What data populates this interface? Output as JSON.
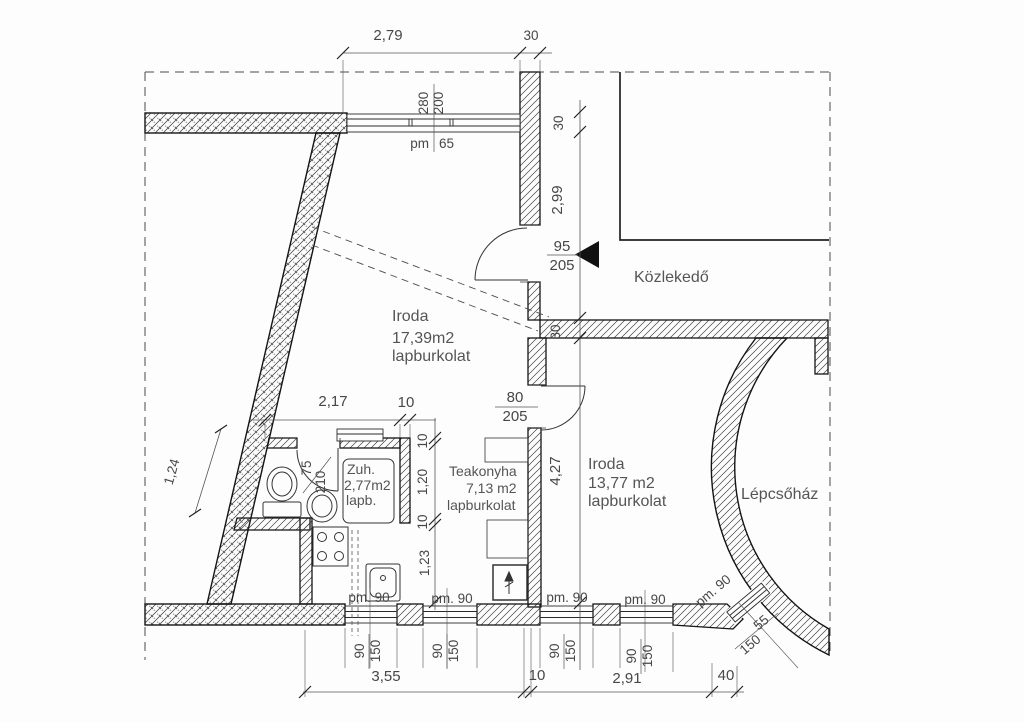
{
  "rooms": {
    "iroda1": {
      "l1": "Iroda",
      "l2": "17,39m2",
      "l3": "lapburkolat"
    },
    "iroda2": {
      "l1": "Iroda",
      "l2": "13,77 m2",
      "l3": "lapburkolat"
    },
    "teakonyha": {
      "l1": "Teakonyha",
      "l2": "7,13 m2",
      "l3": "lapburkolat"
    },
    "zuhanyzo": {
      "l1": "Zuh.",
      "l2": "2,77m2",
      "l3": "lapb."
    },
    "kozlekedo": {
      "l1": "Közlekedő"
    },
    "lepcsohaz": {
      "l1": "Lépcsőház"
    }
  },
  "dims": {
    "top_width": "2,79",
    "top_wall": "30",
    "win_top": {
      "w": "280",
      "h": "200",
      "pm": "pm",
      "sill": "65"
    },
    "right": {
      "wall_top": "30",
      "len": "2,99",
      "wall_mid": "30",
      "len2": "4,27"
    },
    "entry": {
      "w": "95",
      "h": "205"
    },
    "door2": {
      "w": "80",
      "h": "205"
    },
    "bath": {
      "width": "2,17",
      "wall": "10"
    },
    "bathdoor": {
      "w": "75",
      "h": "210"
    },
    "left_chain": {
      "a": "10",
      "b": "1,20",
      "c": "10",
      "d": "1,23"
    },
    "diag": "1,24",
    "bottom": {
      "d1": "3,55",
      "d2": "10",
      "d3": "2,91",
      "d4": "40"
    },
    "win_a": {
      "pm": "pm. 90",
      "w": "90",
      "h": "150"
    },
    "win_b": {
      "pm": "pm. 90",
      "w": "90",
      "h": "150"
    },
    "win_c": {
      "pm": "pm. 90",
      "w": "90",
      "h": "150"
    },
    "win_d": {
      "pm": "pm. 90",
      "w": "90",
      "h": "150"
    },
    "win_e": {
      "pm": "pm. 90",
      "w": "55",
      "h": "150"
    }
  },
  "colors": {
    "line": "#161616",
    "dimline": "#555555",
    "text": "#474747",
    "paper": "#fdfdfd"
  }
}
